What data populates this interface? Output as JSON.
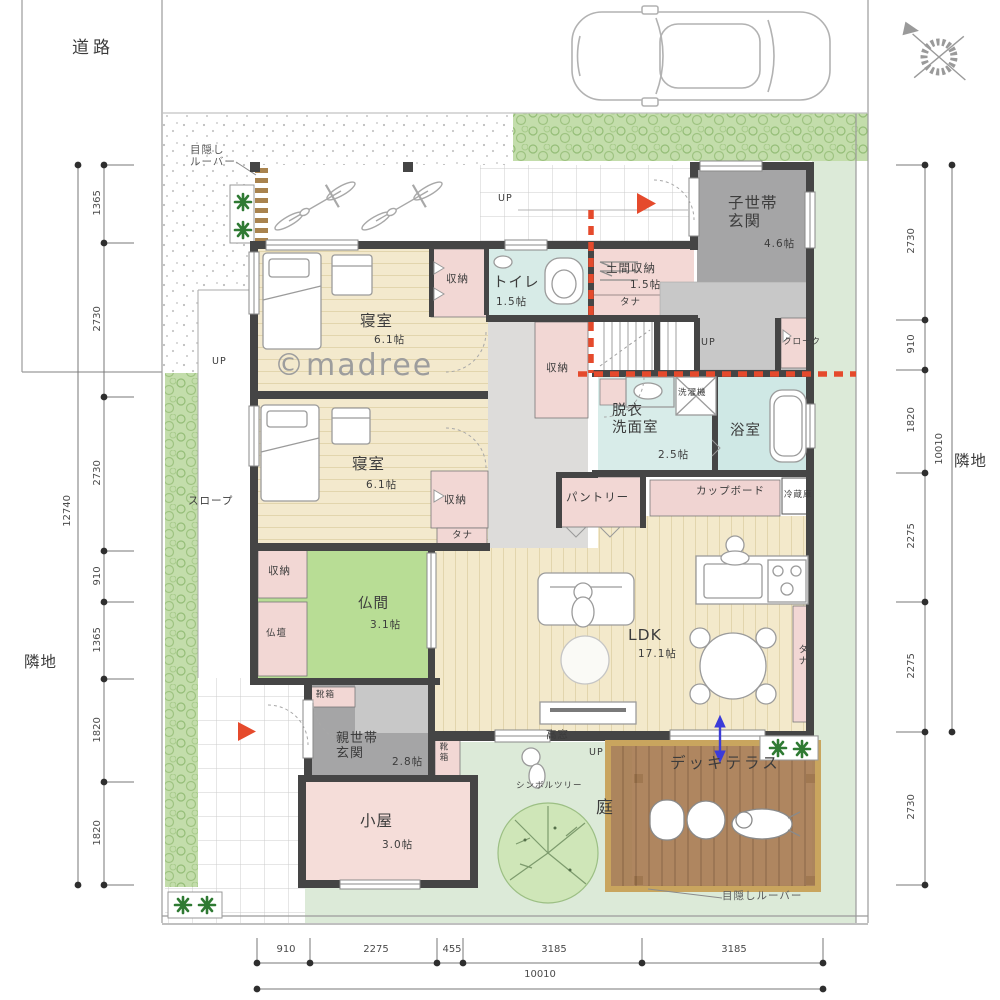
{
  "site": {
    "road": "道路",
    "neighbor": "隣地",
    "privacy_louver_top": "目隠し\nルーバー",
    "privacy_louver_bottom": "目隠しルーバー",
    "watermark": "©madree",
    "garden": "庭",
    "symbol_tree": "シンボルツリー"
  },
  "rooms": {
    "bedroom1": {
      "name": "寝室",
      "size": "6.1帖"
    },
    "bedroom2": {
      "name": "寝室",
      "size": "6.1帖"
    },
    "toilet": {
      "name": "トイレ",
      "size": "1.5帖"
    },
    "doma_storage": {
      "name": "土間収納",
      "size": "1.5帖"
    },
    "child_entrance": {
      "name": "子世帯\n玄関",
      "size": "4.6帖"
    },
    "cloak": {
      "name": "クローク"
    },
    "washroom": {
      "name": "脱衣\n洗面室",
      "size": "2.5帖"
    },
    "bath": {
      "name": "浴室"
    },
    "pantry": {
      "name": "パントリー"
    },
    "ldk": {
      "name": "LDK",
      "size": "17.1帖"
    },
    "butsuma": {
      "name": "仏間",
      "size": "3.1帖"
    },
    "butsudan": {
      "name": "仏壇"
    },
    "parent_entrance": {
      "name": "親世帯\n玄関",
      "size": "2.8帖"
    },
    "koya": {
      "name": "小屋",
      "size": "3.0帖"
    },
    "deck": {
      "name": "デッキテラス"
    }
  },
  "fixtures": {
    "closet": "収納",
    "shelf": "タナ",
    "shoe_box": "靴箱",
    "washer": "洗濯機",
    "cupboard": "カップボード",
    "fridge": "冷蔵庫",
    "high_window": "高窓",
    "up": "UP",
    "slope": "スロープ"
  },
  "dimensions": {
    "left": {
      "segments": [
        "1365",
        "2730",
        "2730",
        "910",
        "1365",
        "1820",
        "1820"
      ],
      "total": "12740"
    },
    "right": {
      "segments": [
        "2730",
        "910",
        "1820",
        "2275",
        "2275",
        "2730"
      ],
      "total": "10010"
    },
    "bottom": {
      "segments": [
        "910",
        "2275",
        "455",
        "3185",
        "3185"
      ],
      "total": "10010"
    }
  },
  "colors": {
    "wall": "#454545",
    "wood_floor": "#f3e9cc",
    "tatami_green": "#b8dd95",
    "water_blue": "#d7ebe7",
    "closet_pink": "#f2d7d4",
    "entrance_gray": "#a5a5a6",
    "deck_brown": "#a87c52",
    "lawn_green": "#dcead8",
    "hedge_green": "#c3ddab",
    "boundary_red": "#e54a2c",
    "flow_blue": "#3b3bd8"
  }
}
